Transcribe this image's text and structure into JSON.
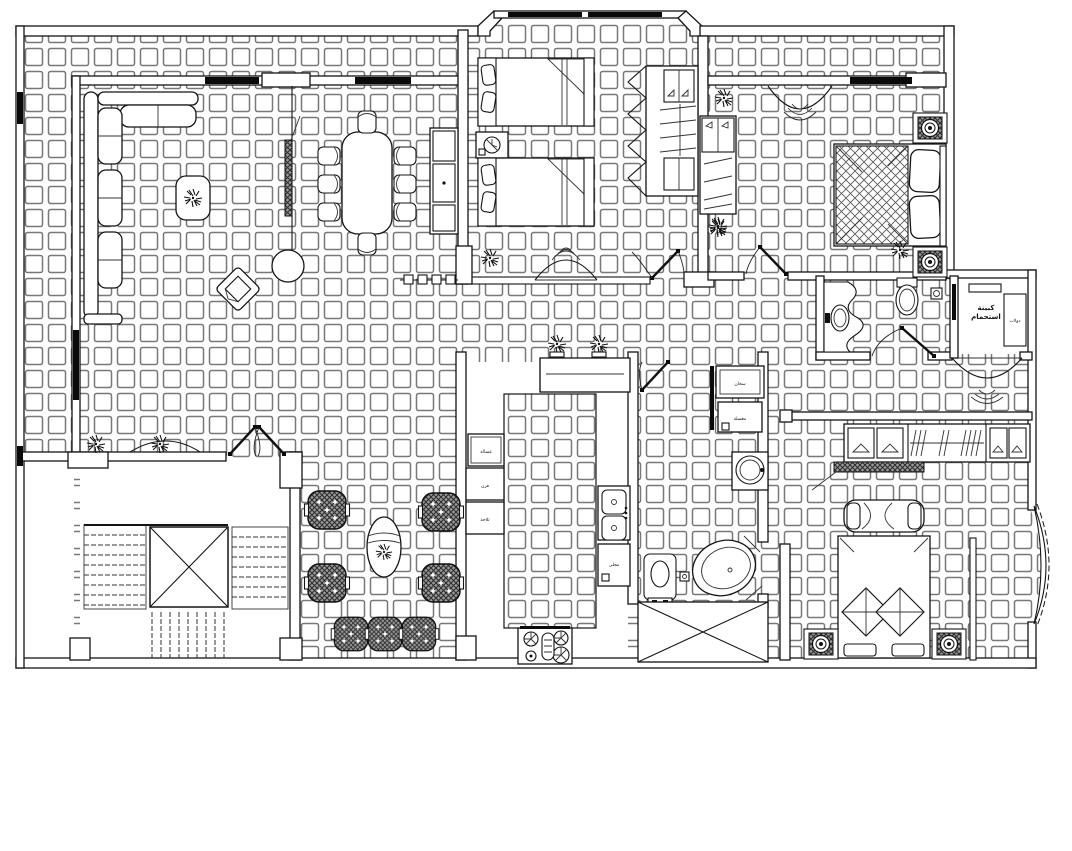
{
  "labels": {
    "shower_room_line1": "كبينة",
    "shower_room_line2": "استحمام",
    "shower_cabinet_tag": "دولاب",
    "bath_heater_box": "سخان",
    "bath_storage_box": "مغسلة",
    "kitchen_box_1": "غسالة",
    "kitchen_box_2": "فرن",
    "kitchen_box_3": "ثلاجة",
    "kitchen_sink_box": "مجلى"
  },
  "colors": {
    "line": "#141414",
    "tile_line": "#787878",
    "window": "#0a0a0a",
    "background": "#ffffff",
    "upholstery": "#9a9a9a"
  },
  "inventory": {
    "drawing_type": "apartment-floor-plan",
    "rooms": [
      "living-dining-room",
      "kids-bedroom",
      "master-bedroom",
      "guest-bathroom",
      "shower-cabin-room",
      "hallway",
      "kitchen",
      "bathroom-2",
      "stairwell",
      "majlis-seating",
      "bedroom-2",
      "terrace-strip"
    ],
    "symbols": [
      "l-shaped-sofa",
      "coffee-table",
      "tv-partition",
      "column",
      "armchair-diagonal",
      "dining-table-8-chairs",
      "sideboard",
      "single-bed",
      "nightstand-clock",
      "bifold-wardrobe",
      "double-bed",
      "dresser",
      "ceiling-lamp-arch",
      "decorative-washbasin",
      "toilet",
      "arched-niche",
      "hanging-wardrobe-row",
      "bench",
      "table-lamp",
      "corner-bathtub",
      "round-washbasin",
      "double-sink",
      "gas-stove",
      "appliance-cabinet",
      "light-shaft-x",
      "u-stair-flight",
      "upholstered-stool",
      "oval-side-table",
      "potted-plant",
      "door-swing",
      "window-bar"
    ]
  }
}
